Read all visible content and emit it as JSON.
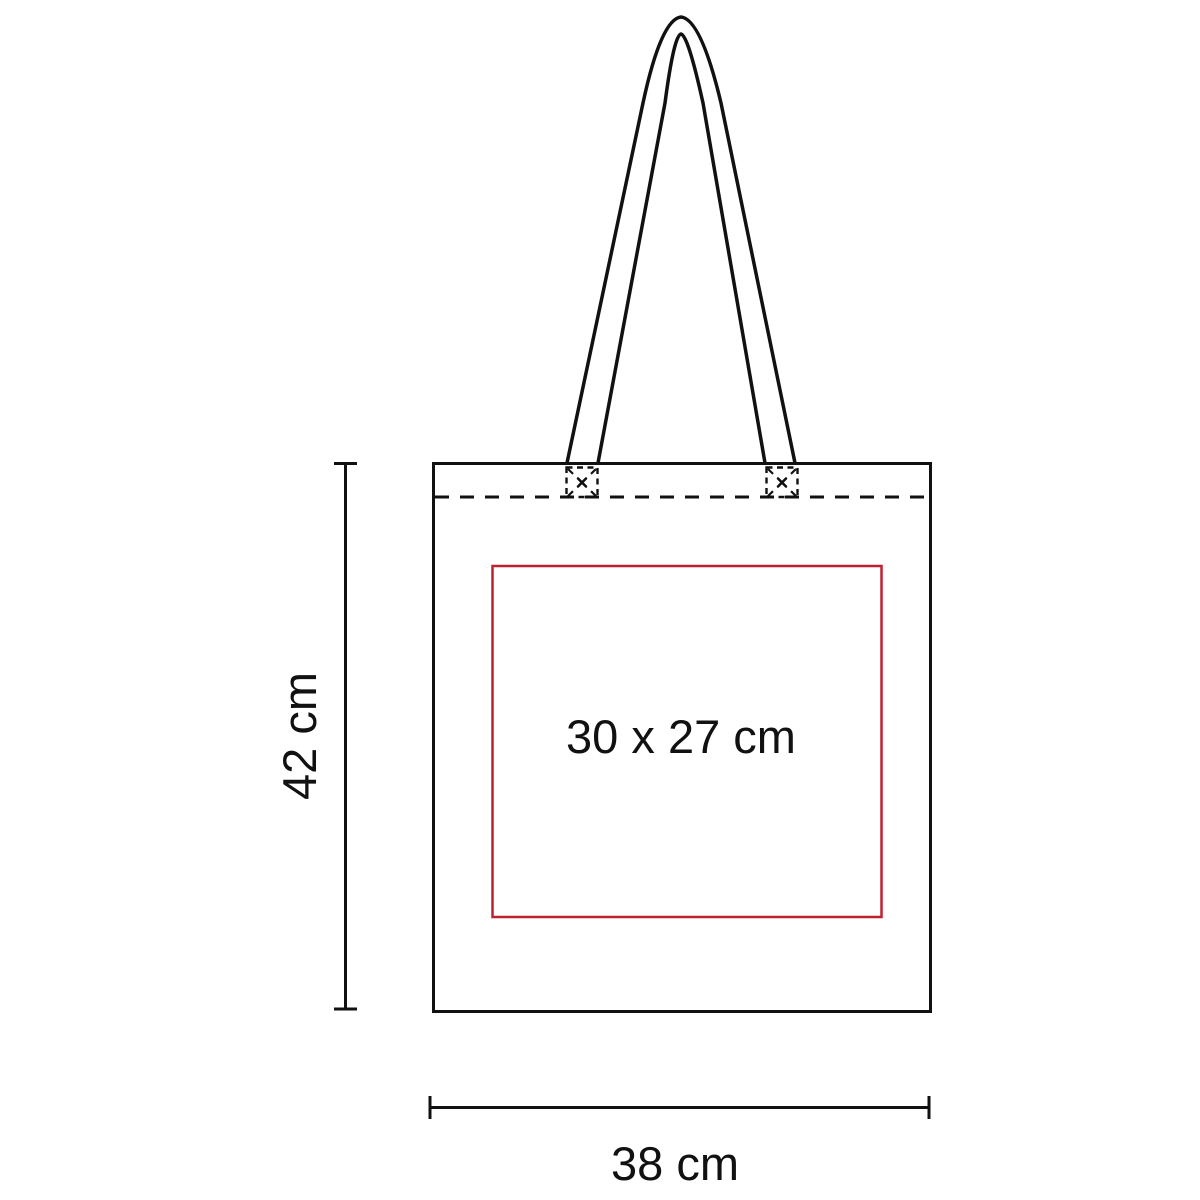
{
  "page": {
    "title": "Tote bag print area dimension diagram",
    "background_color": "#ffffff"
  },
  "diagram": {
    "product": "tote-bag",
    "outline_color": "#111111",
    "print_area": {
      "label": "30 x 27 cm",
      "width_cm": 30,
      "height_cm": 27,
      "border_color": "#be2130"
    },
    "dimensions": {
      "height": {
        "label": "42 cm",
        "value_cm": 42
      },
      "width": {
        "label": "38 cm",
        "value_cm": 38
      }
    }
  }
}
